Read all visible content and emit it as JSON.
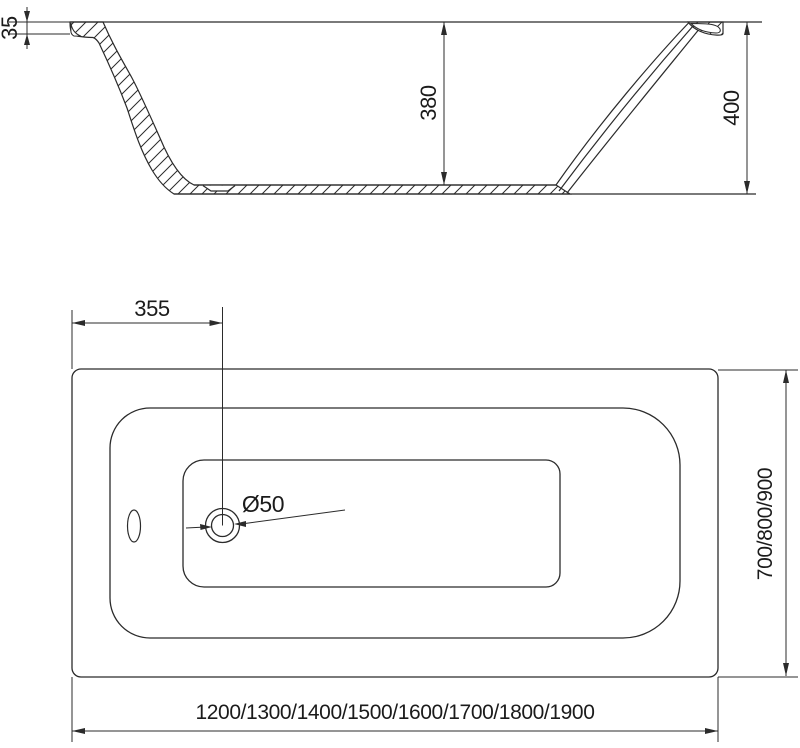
{
  "drawing": {
    "title": "bathtub-technical-drawing",
    "colors": {
      "line": "#2b2b2b",
      "text": "#1b1b1b",
      "background": "#ffffff"
    },
    "side_view": {
      "name": "longitudinal section",
      "dims": {
        "rim_thickness": "35",
        "inner_depth": "380",
        "overall_height": "400"
      }
    },
    "plan_view": {
      "name": "top plan",
      "dims": {
        "drain_offset": "355",
        "drain_diameter": "Ø50",
        "width_options": "700/800/900",
        "length_options": "1200/1300/1400/1500/1600/1700/1800/1900"
      }
    }
  }
}
